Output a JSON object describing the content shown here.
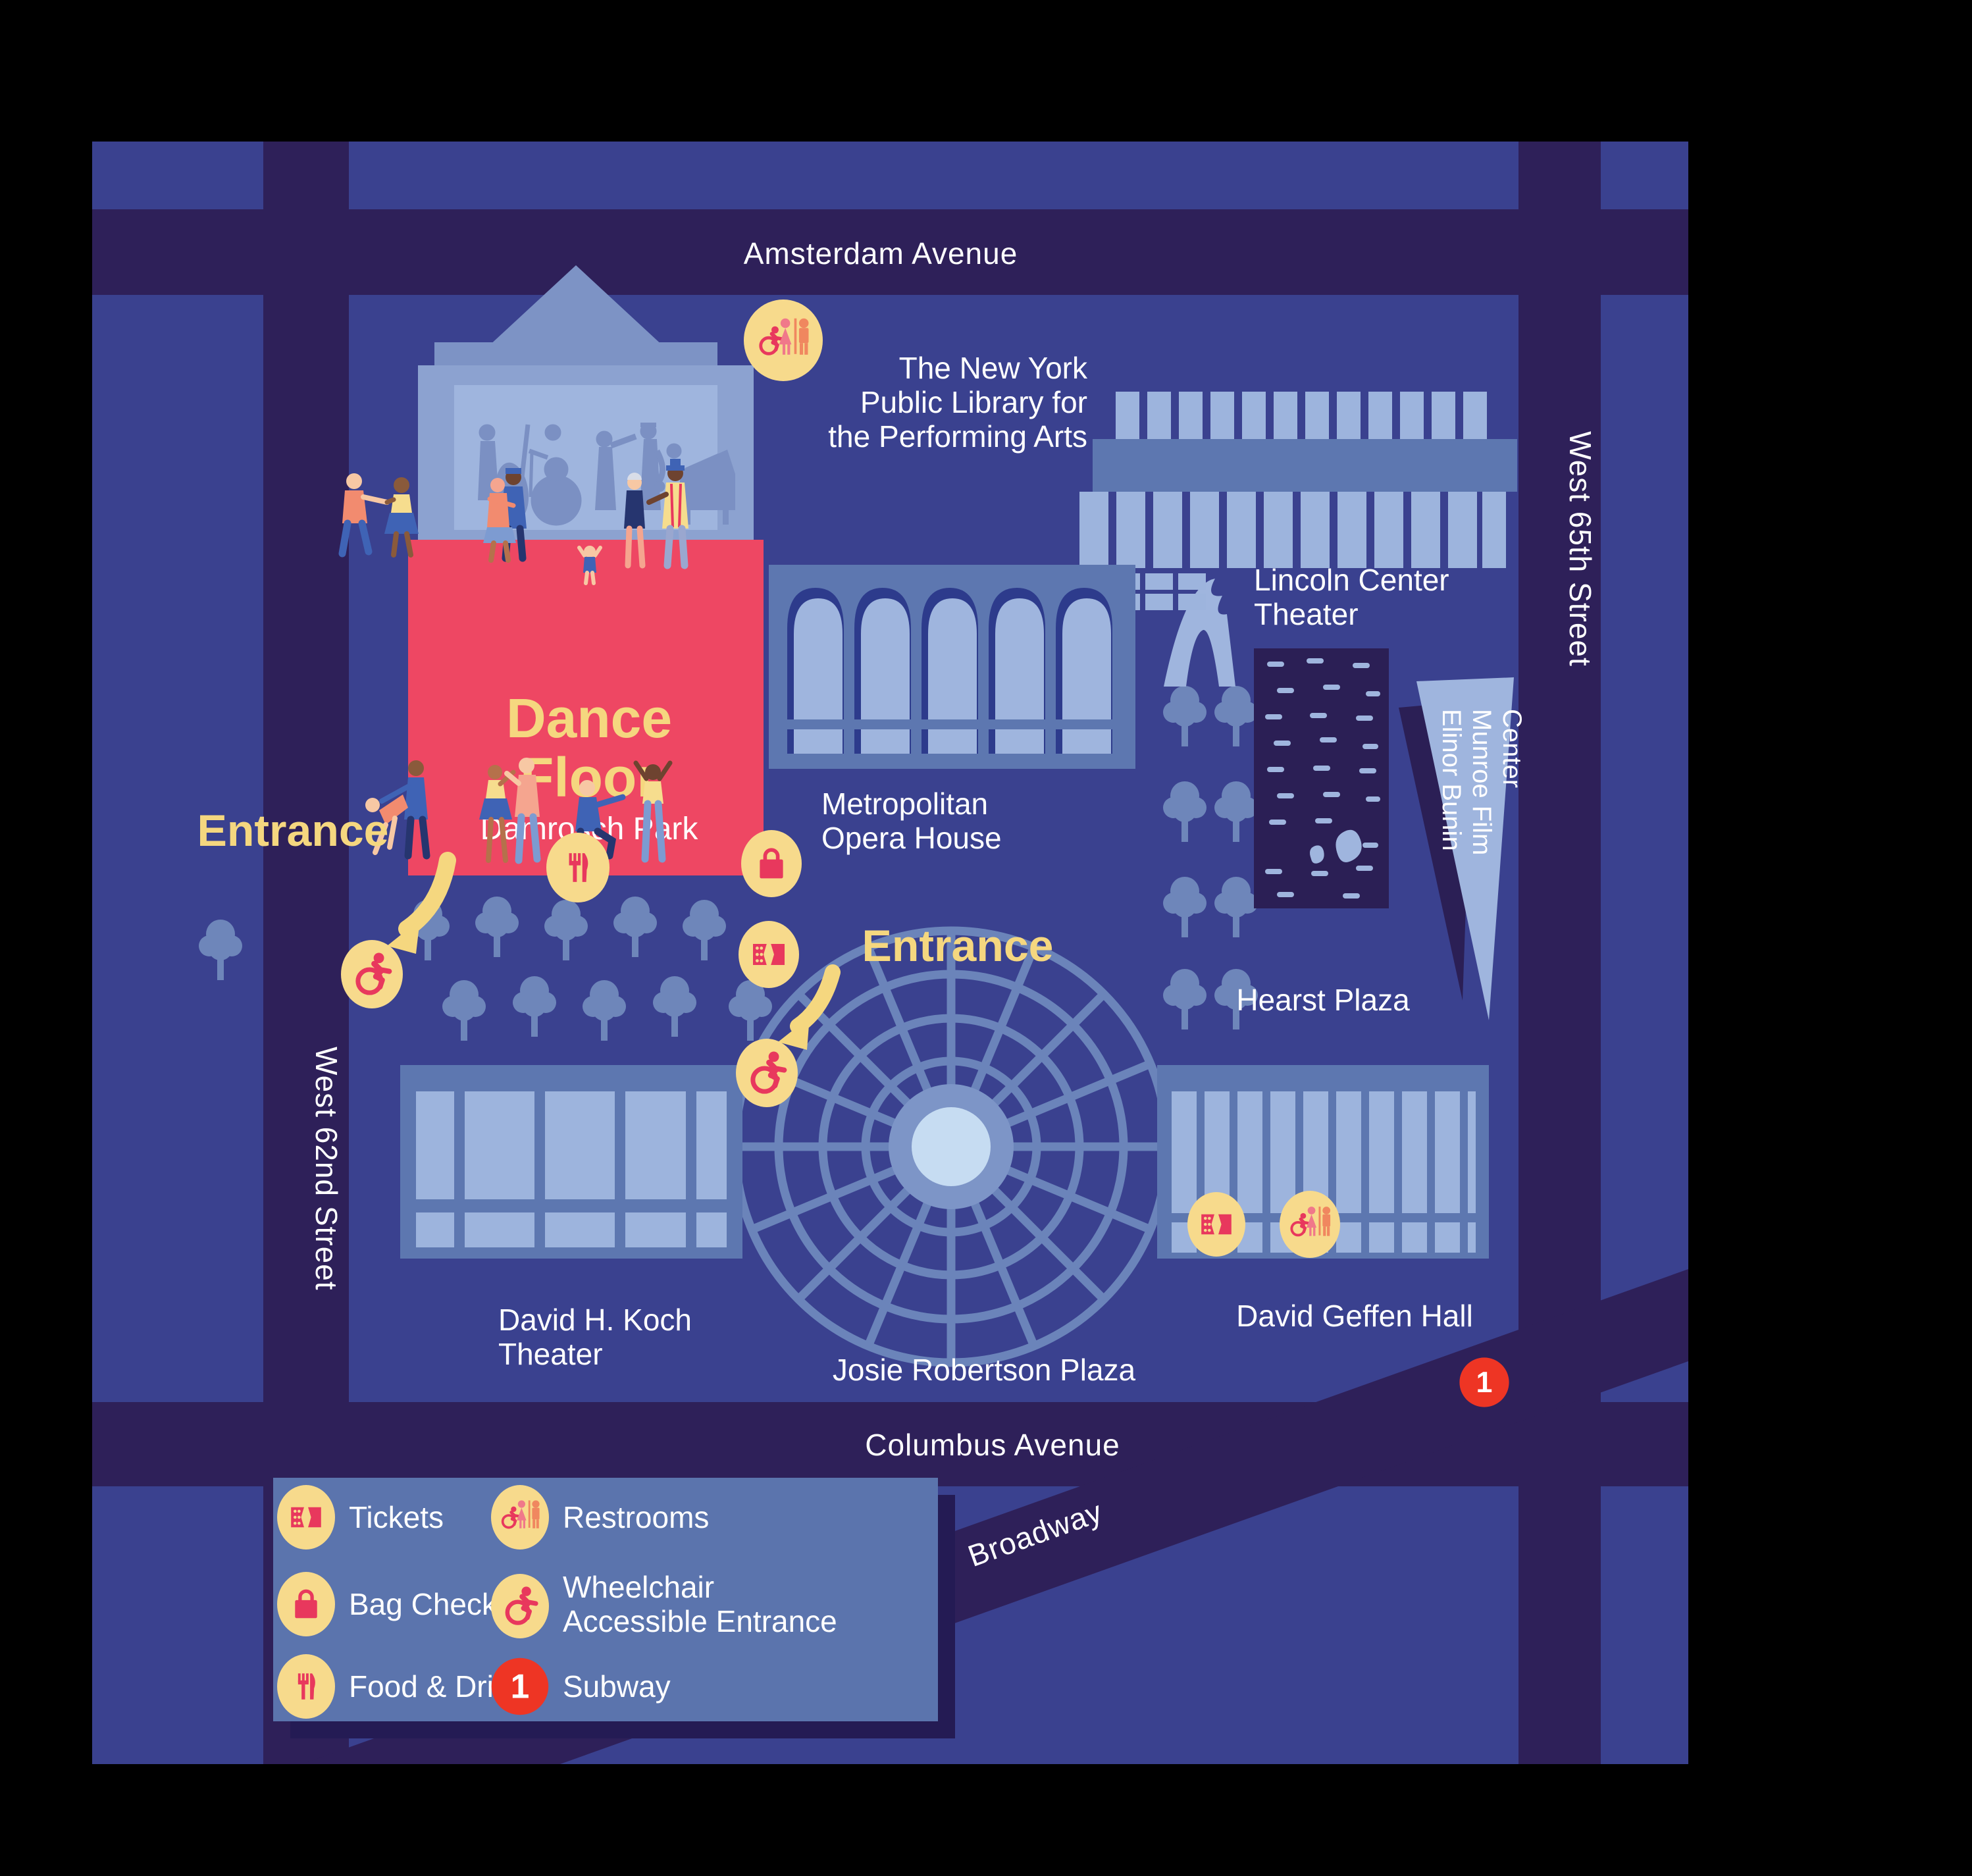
{
  "title": "Lincoln Center Dance Floor event map",
  "streets": {
    "amsterdam": "Amsterdam Avenue",
    "columbus": "Columbus Avenue",
    "west62": "West 62nd Street",
    "west65": "West 65th Street",
    "broadway": "Broadway"
  },
  "dance_floor": {
    "title_line1": "Dance",
    "title_line2": "Floor",
    "subtitle": "Damrosch Park"
  },
  "entrances": {
    "left": "Entrance",
    "right": "Entrance"
  },
  "venues": {
    "library": [
      "The New York",
      "Public Library for",
      "the Performing Arts"
    ],
    "lincoln_center_theater": [
      "Lincoln Center",
      "Theater"
    ],
    "met_opera": [
      "Metropolitan",
      "Opera House"
    ],
    "film_center": [
      "Elinor Bunin",
      "Munroe Film",
      "Center"
    ],
    "hearst": "Hearst Plaza",
    "koch": [
      "David H. Koch",
      "Theater"
    ],
    "geffen": "David Geffen Hall",
    "josie": "Josie Robertson Plaza"
  },
  "legend": {
    "tickets": "Tickets",
    "bag_check": "Bag Check",
    "food_drink": "Food & Drink",
    "restrooms": "Restrooms",
    "wheelchair_line1": "Wheelchair",
    "wheelchair_line2": "Accessible Entrance",
    "subway": "Subway"
  },
  "subway": {
    "line": "1"
  },
  "icons": [
    "tickets-icon",
    "bag-check-icon",
    "food-drink-icon",
    "restrooms-icon",
    "wheelchair-entrance-icon",
    "subway-icon"
  ],
  "palette": {
    "background": "#000000",
    "map_blue": "#3a418f",
    "street_purple": "#2e2059",
    "building_mid": "#5d77b0",
    "building_light": "#9db4dd",
    "bandshell_wall": "#8ca2d0",
    "bandshell_inner": "#9fb5de",
    "silhouette_blue": "#7b90c3",
    "tree_blue": "#6e86ba",
    "plaza_web": "#6b84ba",
    "plaza_center": "#c6dcf2",
    "pool_navy": "#2b1f55",
    "dance_floor_red": "#ee4763",
    "icon_red": "#e8385d",
    "icon_orange": "#f0875f",
    "icon_pink": "#f0788a",
    "icon_badge_yellow": "#f7da8c",
    "accent_yellow": "#f5d77f",
    "legend_bg": "#5b74ad",
    "shadow_navy": "#241b54",
    "subway_red": "#ee3524"
  }
}
